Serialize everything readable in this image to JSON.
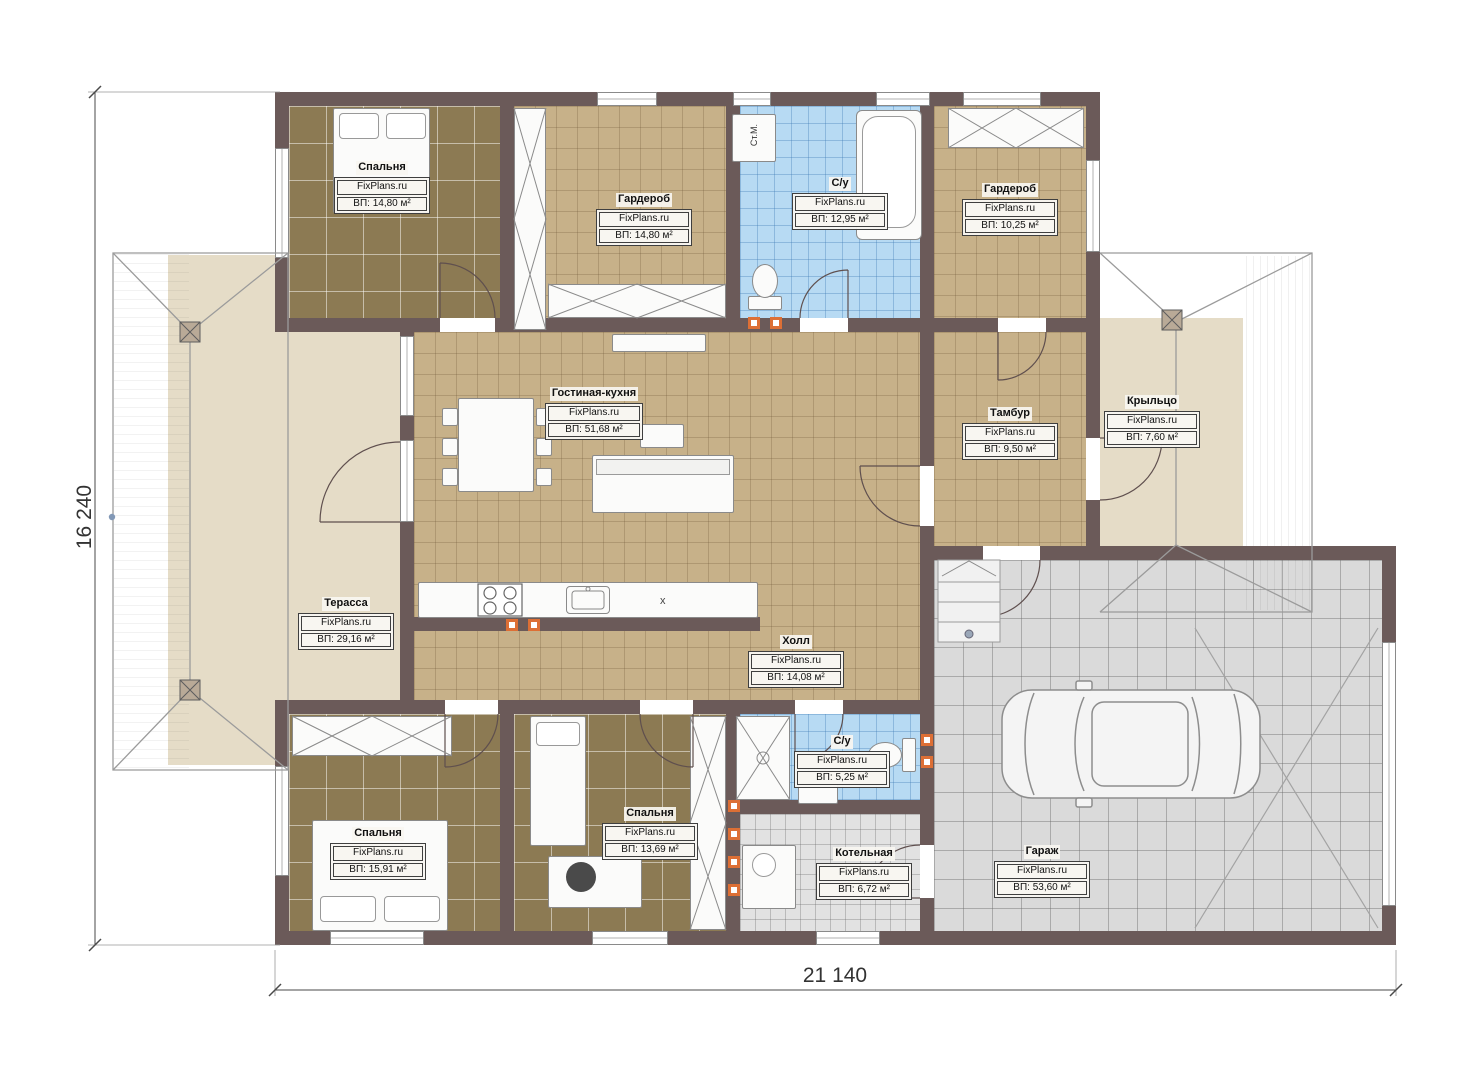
{
  "plan": {
    "brand": "FixPlans.ru",
    "washing_machine_label": "Ст.М.",
    "kitchen_marker": "x",
    "dimensions": {
      "width": "21 140",
      "height": "16 240"
    },
    "rooms": [
      {
        "name": "Спальня",
        "area": "ВП: 14,80 м²"
      },
      {
        "name": "Гардероб",
        "area": "ВП: 14,80 м²"
      },
      {
        "name": "С/у",
        "area": "ВП: 12,95 м²"
      },
      {
        "name": "Гардероб",
        "area": "ВП: 10,25 м²"
      },
      {
        "name": "Гостиная-кухня",
        "area": "ВП: 51,68 м²"
      },
      {
        "name": "Тамбур",
        "area": "ВП: 9,50 м²"
      },
      {
        "name": "Крыльцо",
        "area": "ВП: 7,60 м²"
      },
      {
        "name": "Терасса",
        "area": "ВП: 29,16 м²"
      },
      {
        "name": "Холл",
        "area": "ВП: 14,08 м²"
      },
      {
        "name": "Спальня",
        "area": "ВП: 15,91 м²"
      },
      {
        "name": "Спальня",
        "area": "ВП: 13,69 м²"
      },
      {
        "name": "С/у",
        "area": "ВП: 5,25 м²"
      },
      {
        "name": "Котельная",
        "area": "ВП: 6,72 м²"
      },
      {
        "name": "Гараж",
        "area": "ВП: 53,60 м²"
      }
    ],
    "colors": {
      "wall": "#6b5a59",
      "bedroom_floor": "#8c7a53",
      "tile_floor": "#c7b189",
      "bath_floor": "#b7daf3",
      "garage_floor": "#dadada",
      "terrace_floor": "#e5dcc7",
      "outlet": "#dd6f35"
    }
  }
}
